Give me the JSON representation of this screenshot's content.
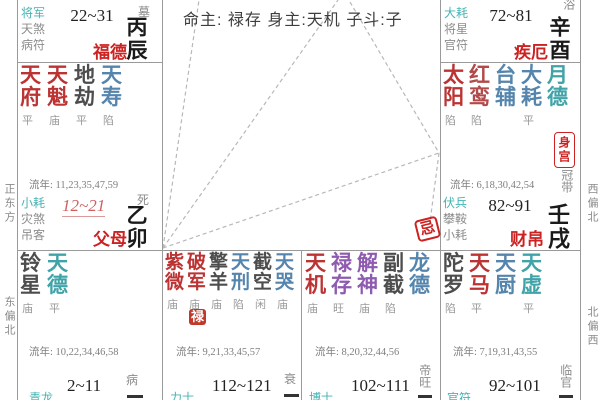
{
  "center": {
    "info": "命主: 禄存 身主:天机 子斗:子"
  },
  "margins": {
    "left_top": "正东方",
    "left_bottom": "东偏北",
    "right_top": "西偏北",
    "right_bottom": "北偏西"
  },
  "palette": {
    "accent_red": "#cc2222",
    "star_major": "#bb3333",
    "star_blue": "#5585ad",
    "star_teal": "#3fa3a8",
    "star_dark": "#4d4d4d",
    "star_purple": "#8e5bb0",
    "god_cyan": "#45b3b3"
  },
  "palaces": {
    "fude": {
      "gods": [
        "将军",
        "天煞",
        "病符"
      ],
      "age_range": "22~31",
      "name": "福德",
      "stage": "墓",
      "stem_branch": "丙辰"
    },
    "jie": {
      "gods": [
        "大耗",
        "将星",
        "官符"
      ],
      "age_range": "72~81",
      "name": "疾厄",
      "stage": "沐浴",
      "stem_branch": "辛酉"
    },
    "fumu": {
      "stars": [
        {
          "name": "天府",
          "bright": "平",
          "color": "#bb3333"
        },
        {
          "name": "天魁",
          "bright": "庙",
          "color": "#bb3333"
        },
        {
          "name": "地劫",
          "bright": "平",
          "color": "#4d4d4d"
        },
        {
          "name": "天寿",
          "bright": "陷",
          "color": "#5585ad"
        }
      ],
      "liunian": "流年: 11,23,35,47,59",
      "gods": [
        "小耗",
        "灾煞",
        "吊客"
      ],
      "age_range": "12~21",
      "name": "父母",
      "stage": "死",
      "stem_branch": "乙卯"
    },
    "caibo": {
      "stars": [
        {
          "name": "太阳",
          "bright": "陷",
          "color": "#bb3333"
        },
        {
          "name": "红鸾",
          "bright": "陷",
          "color": "#b14a4a"
        },
        {
          "name": "台辅",
          "bright": "",
          "color": "#5585ad"
        },
        {
          "name": "大耗",
          "bright": "平",
          "color": "#5585ad"
        },
        {
          "name": "月德",
          "bright": "",
          "color": "#3fa3a8"
        }
      ],
      "liunian": "流年: 6,18,30,42,54",
      "gods": [
        "伏兵",
        "攀鞍",
        "小耗"
      ],
      "age_range": "82~91",
      "name": "财帛",
      "stage": "冠带",
      "stem_branch": "壬戌",
      "body_badge": "身宫",
      "ji_badge": "忌"
    },
    "b1": {
      "stars": [
        {
          "name": "铃星",
          "bright": "庙",
          "color": "#4d4d4d"
        },
        {
          "name": "天德",
          "bright": "平",
          "color": "#3fa3a8"
        }
      ],
      "liunian": "流年: 10,22,34,46,58",
      "god": "青龙",
      "age_range": "2~11",
      "stage": "病"
    },
    "b2": {
      "stars": [
        {
          "name": "紫微",
          "bright": "庙",
          "color": "#bb3333"
        },
        {
          "name": "破军",
          "bright": "庙",
          "color": "#bb3333"
        },
        {
          "name": "擎羊",
          "bright": "庙",
          "color": "#4d4d4d"
        },
        {
          "name": "天刑",
          "bright": "陷",
          "color": "#5585ad"
        },
        {
          "name": "截空",
          "bright": "闲",
          "color": "#4d4d4d"
        },
        {
          "name": "天哭",
          "bright": "庙",
          "color": "#5585ad"
        }
      ],
      "lu_badge": "禄",
      "liunian": "流年: 9,21,33,45,57",
      "god": "力士",
      "age_range": "112~121",
      "stage": "衰"
    },
    "b3": {
      "stars": [
        {
          "name": "天机",
          "bright": "庙",
          "color": "#bb3333"
        },
        {
          "name": "禄存",
          "bright": "旺",
          "color": "#8e5bb0"
        },
        {
          "name": "解神",
          "bright": "庙",
          "color": "#8e5bb0"
        },
        {
          "name": "副截",
          "bright": "陷",
          "color": "#4d4d4d"
        },
        {
          "name": "龙德",
          "bright": "",
          "color": "#5585ad"
        }
      ],
      "liunian": "流年: 8,20,32,44,56",
      "god": "博士",
      "age_range": "102~111",
      "stage": "帝旺"
    },
    "b4": {
      "stars": [
        {
          "name": "陀罗",
          "bright": "陷",
          "color": "#4d4d4d"
        },
        {
          "name": "天马",
          "bright": "平",
          "color": "#bb3333"
        },
        {
          "name": "天厨",
          "bright": "",
          "color": "#5585ad"
        },
        {
          "name": "天虚",
          "bright": "平",
          "color": "#3fa3a8"
        }
      ],
      "liunian": "流年: 7,19,31,43,55",
      "god": "官符",
      "age_range": "92~101",
      "stage": "临官"
    }
  }
}
